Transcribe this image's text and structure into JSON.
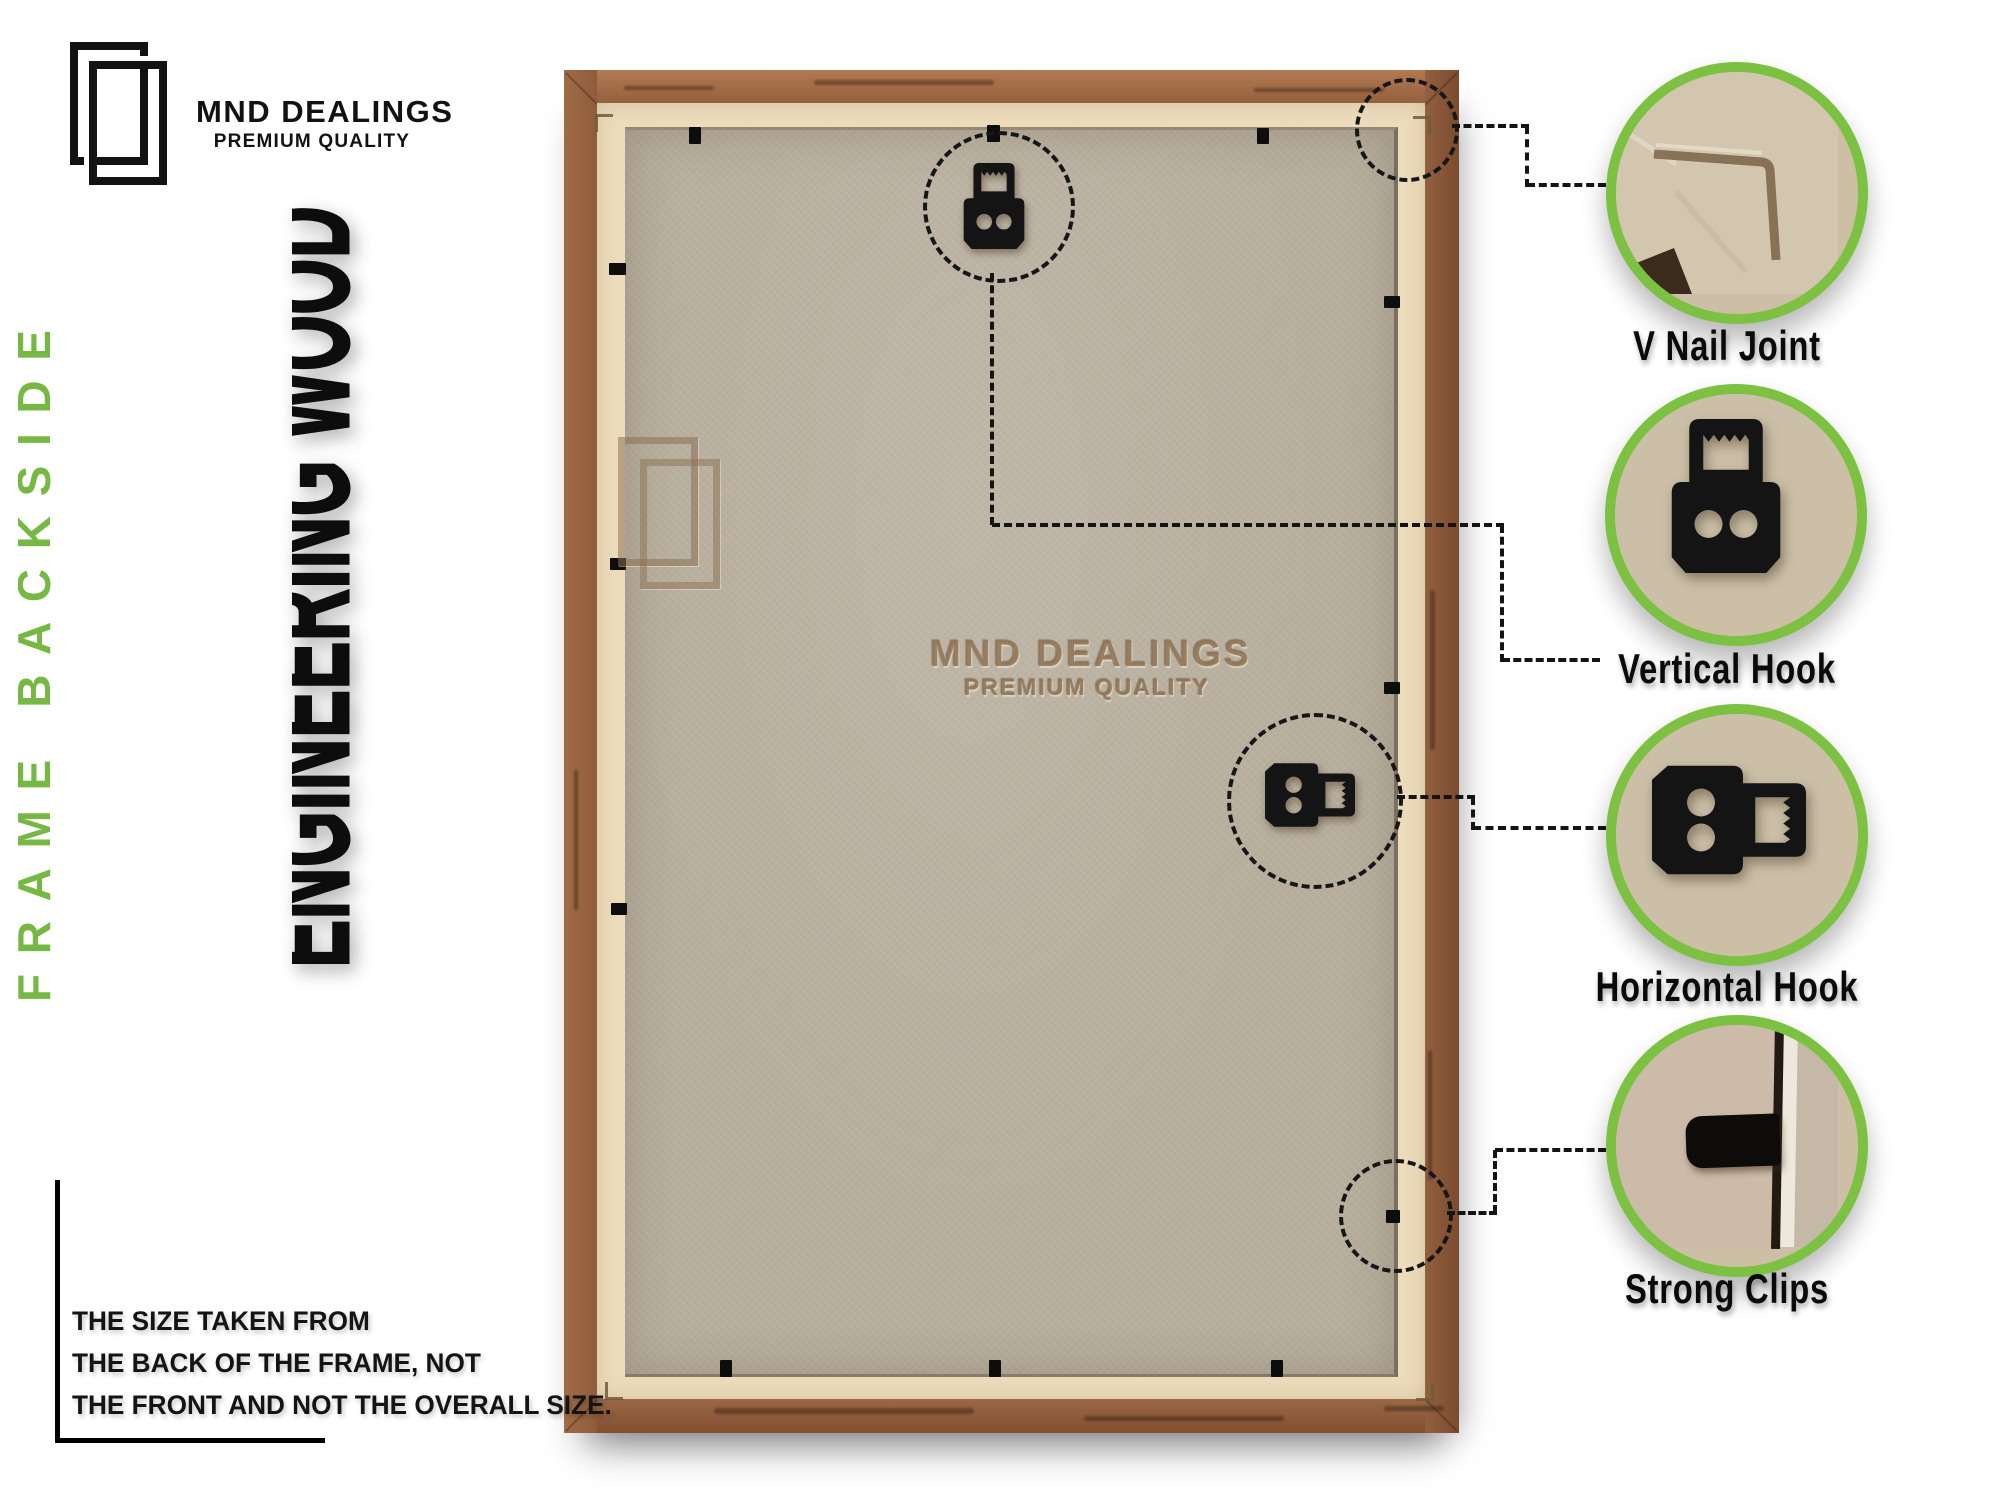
{
  "brand": {
    "name": "MND DEALINGS",
    "tagline": "PREMIUM QUALITY"
  },
  "side_text": "FRAME BACKSIDE",
  "material_text": "ENGINEERING WOOD",
  "watermark": {
    "name": "MND DEALINGS",
    "tagline": "PREMIUM QUALITY"
  },
  "callouts": [
    {
      "id": "v-nail-joint",
      "label": "V Nail Joint"
    },
    {
      "id": "vertical-hook",
      "label": "Vertical Hook"
    },
    {
      "id": "horizontal-hook",
      "label": "Horizontal Hook"
    },
    {
      "id": "strong-clips",
      "label": "Strong Clips"
    }
  ],
  "note_lines": [
    "THE SIZE TAKEN FROM",
    "THE BACK OF THE FRAME, NOT",
    "THE FRONT AND NOT THE OVERALL SIZE."
  ],
  "colors": {
    "accent_green": "#7cc142",
    "text_green": "#76b843",
    "wood_brown": "#9b6845",
    "tape_cream": "#ecdcbc",
    "board_tan": "#b7ae9d",
    "ink": "#111111"
  }
}
